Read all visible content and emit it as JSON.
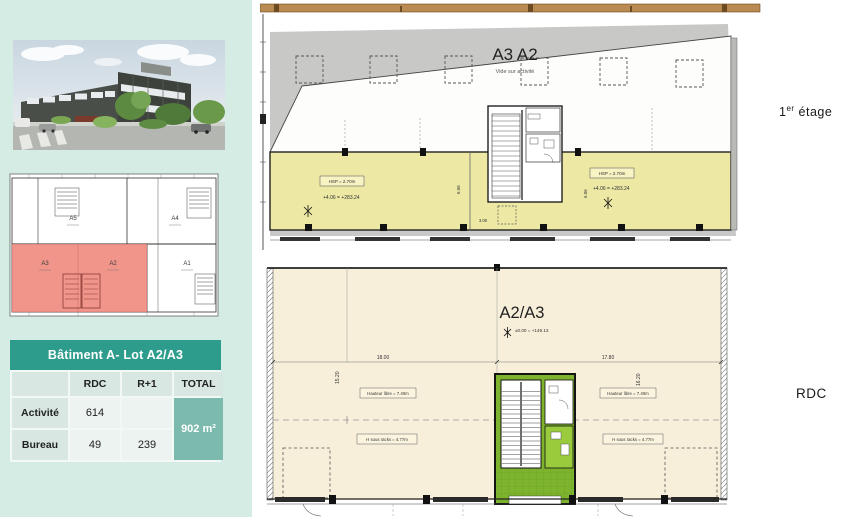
{
  "colors": {
    "panel": "#d5ece5",
    "table_header_teal": "#2e9c8c",
    "table_total_teal": "#7cbaae",
    "plan_office_yellow": "#ede9a5",
    "plan_ground_cream": "#f7efda",
    "plan_hall_green": "#7db32d",
    "siteplan_highlight_red": "#ee8377"
  },
  "photo": {
    "label": "building-exterior-rendering"
  },
  "siteplan": {
    "lots": [
      "A5",
      "A4",
      "A3",
      "A2",
      "A1"
    ]
  },
  "table": {
    "title": "Bâtiment A- Lot A2/A3",
    "col_rdc": "RDC",
    "col_r1": "R+1",
    "col_total": "TOTAL",
    "row1_label": "Activité",
    "row1_rdc": "614",
    "row1_r1": "",
    "row2_label": "Bureau",
    "row2_rdc": "49",
    "row2_r1": "239",
    "total": "902 m²"
  },
  "plan_etage": {
    "title": "A3 A2",
    "subtitle": "Vide sur activité",
    "floor": {
      "prefix": "1",
      "sup": "er",
      "suffix": " étage"
    },
    "hsp": "HSP = 2.70m",
    "level": "+4.06 = +283.24",
    "dim_a": "3.08",
    "dim_b": "6.06"
  },
  "plan_rdc": {
    "title": "A2/A3",
    "level": "±0.00 = +149.13",
    "floor": "RDC",
    "dim_left": "18.00",
    "dim_right": "17.80",
    "dim_vleft": "15.20",
    "dim_vright": "16.20",
    "label_height": "Hauteur libre = 7.40m",
    "label_racks": "H sous racks = 4.77m"
  }
}
